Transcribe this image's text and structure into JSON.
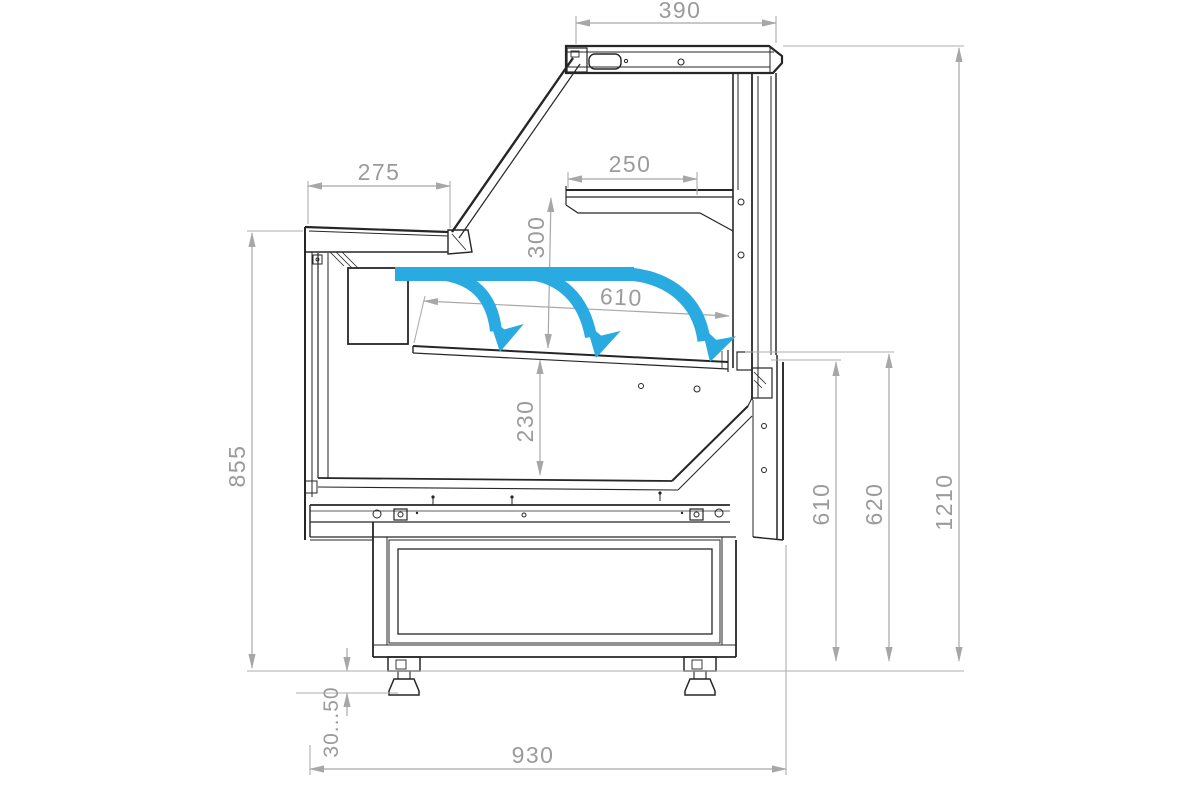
{
  "drawing": {
    "title": "serve-over display counter cross-section",
    "units": "mm",
    "colors": {
      "line": "#262626",
      "dimension_line": "#a7a7a7",
      "dimension_text": "#9b9b9b",
      "airflow": "#29abe2",
      "background": "#ffffff"
    },
    "dimensions": {
      "canopy_width": "390",
      "counter_top_depth": "275",
      "shelf_width": "250",
      "shelf_to_deck": "300",
      "display_deck_width": "610",
      "deck_to_base": "230",
      "front_height": "855",
      "rear_opening_height": "610",
      "rear_wall_height": "620",
      "overall_height": "1210",
      "leg_adjustment": "30...50",
      "base_width": "930"
    }
  }
}
